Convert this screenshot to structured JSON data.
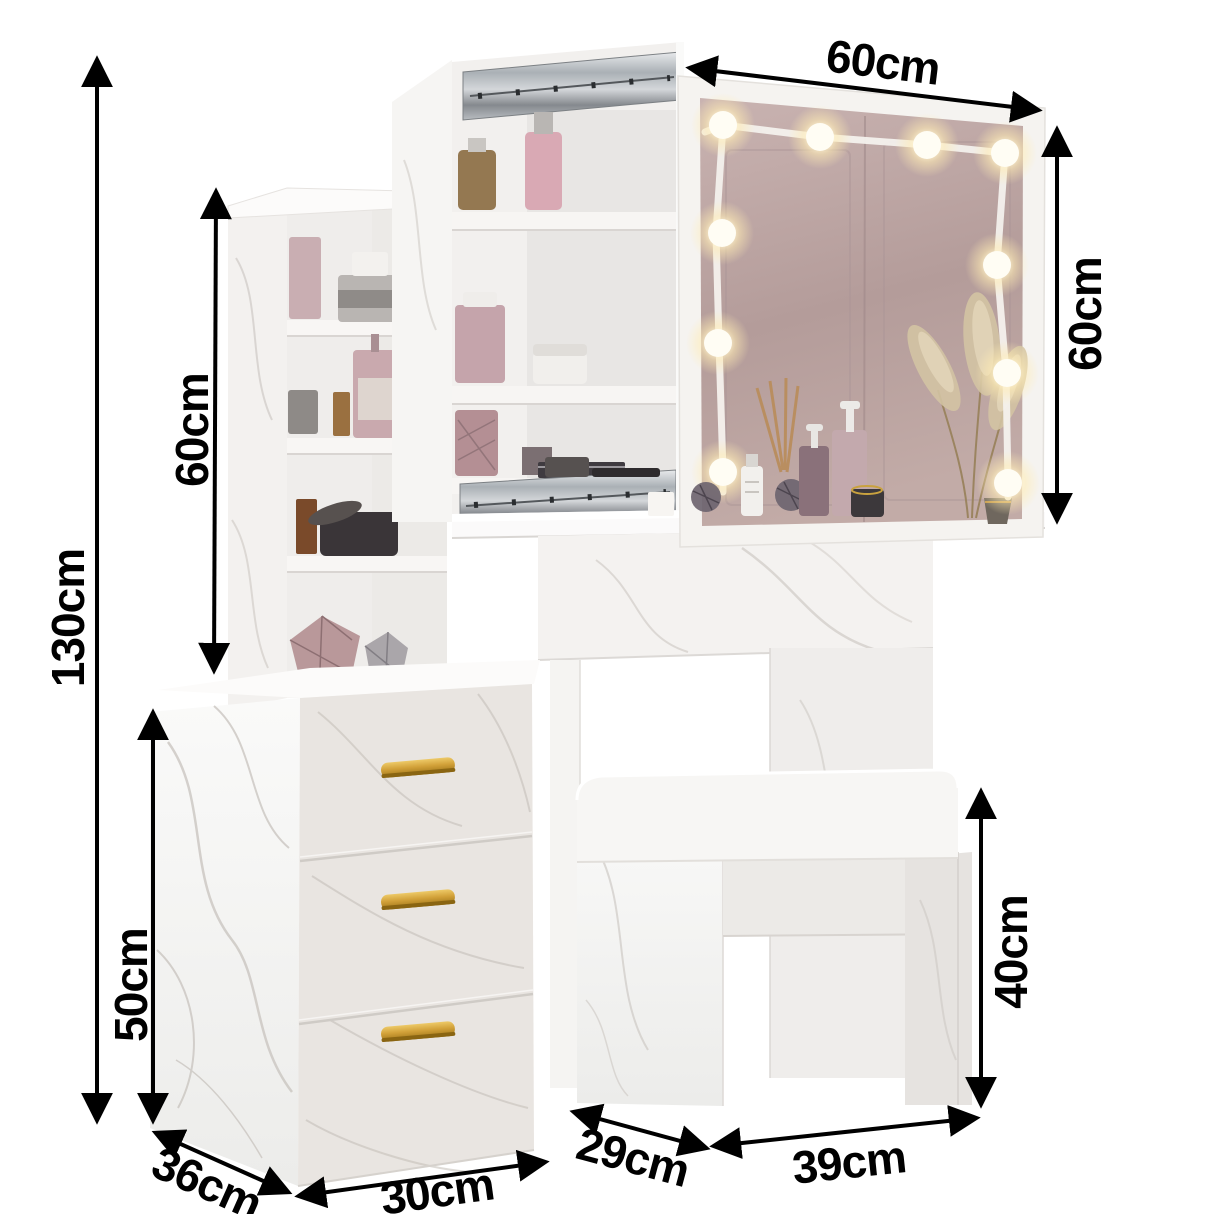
{
  "diagram": {
    "type": "product-dimension-diagram",
    "unit": "cm",
    "background_color": "#ffffff",
    "annotation_color": "#000000",
    "dimensions": [
      {
        "id": "total_height",
        "label": "130cm",
        "orientation": "vertical"
      },
      {
        "id": "shelf_tower_height",
        "label": "60cm",
        "orientation": "vertical"
      },
      {
        "id": "mirror_width",
        "label": "60cm",
        "orientation": "diagonal"
      },
      {
        "id": "mirror_height",
        "label": "60cm",
        "orientation": "vertical"
      },
      {
        "id": "drawer_cabinet_height",
        "label": "50cm",
        "orientation": "vertical"
      },
      {
        "id": "drawer_cabinet_depth",
        "label": "36cm",
        "orientation": "diagonal"
      },
      {
        "id": "drawer_cabinet_width",
        "label": "30cm",
        "orientation": "horizontal"
      },
      {
        "id": "stool_depth",
        "label": "29cm",
        "orientation": "diagonal"
      },
      {
        "id": "stool_width",
        "label": "39cm",
        "orientation": "horizontal"
      },
      {
        "id": "stool_height",
        "label": "40cm",
        "orientation": "vertical"
      }
    ],
    "features": {
      "led_bulb_count": 10,
      "drawer_count": 3,
      "shelf_tower_compartments": 4,
      "handle_color": "#cfa138",
      "marble_vein_color": "#c8c3be",
      "mirror_tint_color": "#bba3a1",
      "bulb_glow_color": "#fff3cf",
      "rail_metal_color": "#aab0b5"
    }
  }
}
